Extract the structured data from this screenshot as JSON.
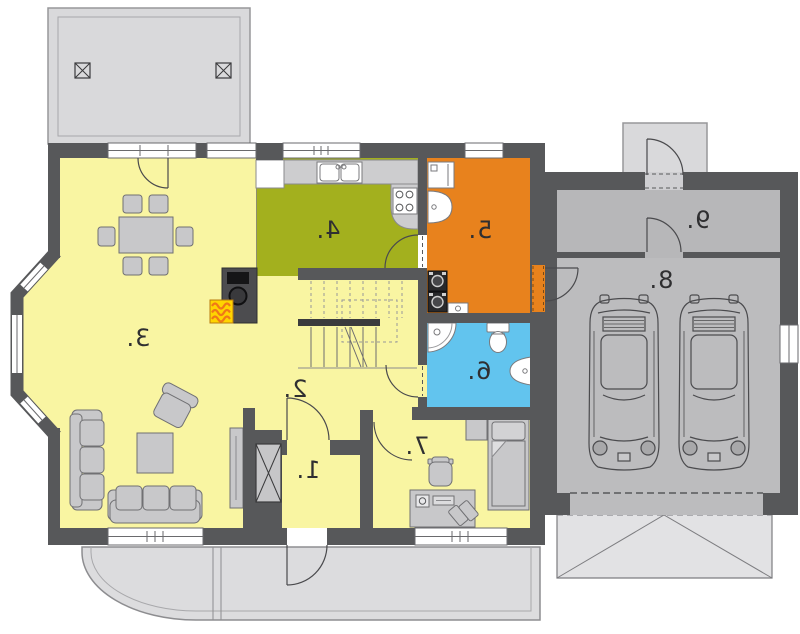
{
  "plan": {
    "rooms": [
      {
        "label": "1."
      },
      {
        "label": "2."
      },
      {
        "label": "3."
      },
      {
        "label": "4."
      },
      {
        "label": "5."
      },
      {
        "label": "6."
      },
      {
        "label": "7."
      },
      {
        "label": "8."
      },
      {
        "label": "9."
      }
    ],
    "palette": {
      "wall": "#57585a",
      "room_yellow": "#f9f5a2",
      "kitchen_green": "#a3b01e",
      "utility_orange": "#e8821d",
      "bath_blue": "#62c4ee",
      "garage_gray": "#bcbcbe",
      "paving_gray": "#d9d9db",
      "flame_yellow": "#ffd400",
      "flame_orange": "#f07818"
    }
  }
}
